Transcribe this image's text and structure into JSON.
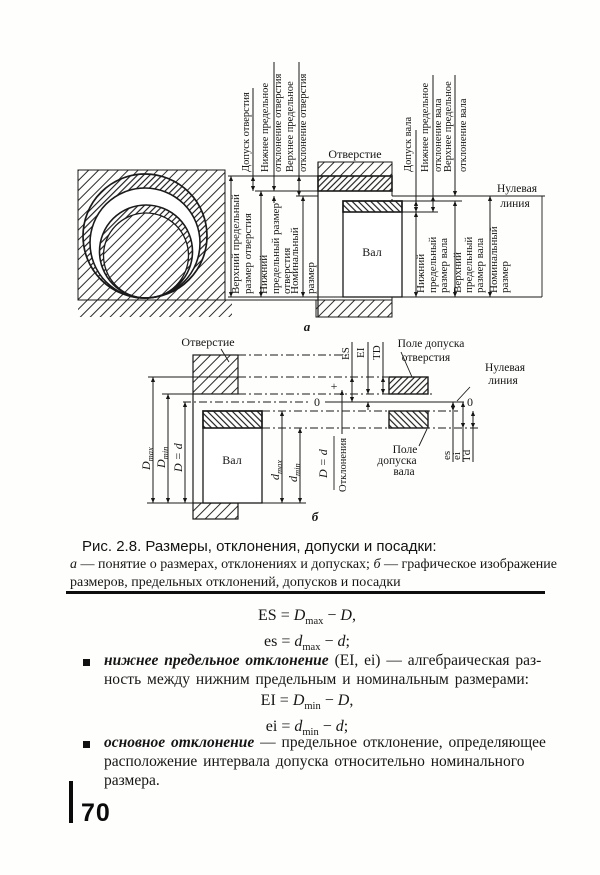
{
  "colors": {
    "ink": "#1a1a1a",
    "paper": "#fefefc"
  },
  "fig_a": {
    "hole": "Отверстие",
    "shaft": "Вал",
    "null1": "Нулевая",
    "null2": "линия",
    "tag": "а",
    "t1": "Допуск отверстия",
    "t2a": "Нижнее предельное",
    "t2b": "отклонение отверстия",
    "t3a": "Верхнее предельное",
    "t3b": "отклонение отверстия",
    "t4": "Допуск вала",
    "t5a": "Нижнее предельное",
    "t5b": "отклонение вала",
    "t6a": "Верхнее предельное",
    "t6b": "отклонение вала",
    "l1a": "Верхний предельный",
    "l1b": "размер отверстия",
    "l2a": "Нижний",
    "l2b": "предельный размер",
    "l2c": "отверстия",
    "l3a": "Номинальный",
    "l3b": "размер",
    "r1a": "Нижний",
    "r1b": "предельный",
    "r1c": "размер вала",
    "r2a": "Верхний",
    "r2b": "предельный",
    "r2c": "размер вала",
    "r3a": "Номинальный",
    "r3b": "размер"
  },
  "fig_b": {
    "hole": "Отверстие",
    "shaft": "Вал",
    "tag": "б",
    "dmax_v": "D",
    "dmax_s": "max",
    "dmin_v": "D",
    "dmin_s": "min",
    "dd": "D = d",
    "sdmax_v": "d",
    "sdmax_s": "max",
    "sdmin_v": "d",
    "sdmin_s": "min",
    "es_h": "ES",
    "ei_h": "EI",
    "td_h": "TD",
    "es_s": "es",
    "ei_s": "ei",
    "td_s": "Td",
    "plus": "+",
    "zero_l": "0",
    "zero_r": "0",
    "field_hole1": "Поле допуска",
    "field_hole2": "отверстия",
    "null1": "Нулевая",
    "null2": "линия",
    "field_shaft1": "Поле",
    "field_shaft2": "допуска",
    "field_shaft3": "вала",
    "axis_num": "D = d",
    "axis_den": "Отклонения"
  },
  "caption": {
    "title": "Рис. 2.8. Размеры, отклонения, допуски и посадки:",
    "legend_a": "а",
    "legend_a_text": " — понятие о размерах, отклонениях и допусках; ",
    "legend_b": "б",
    "legend_b_text": " — графическое изображение",
    "legend_line2": "размеров, предельных отклонений, допусков и посадки"
  },
  "formulas": {
    "f1": {
      "lhs": "ES",
      "eq": " = ",
      "v1": "D",
      "s1": "max",
      "op": " − ",
      "v2": "D",
      "end": ","
    },
    "f2": {
      "lhs": "es",
      "eq": " = ",
      "v1": "d",
      "s1": "max",
      "op": " − ",
      "v2": "d",
      "end": ";"
    },
    "f3": {
      "lhs": "EI",
      "eq": " = ",
      "v1": "D",
      "s1": "min",
      "op": " − ",
      "v2": "D",
      "end": ","
    },
    "f4": {
      "lhs": "ei",
      "eq": " = ",
      "v1": "d",
      "s1": "min",
      "op": " − ",
      "v2": "d",
      "end": ";"
    }
  },
  "bullets": {
    "b1_bold": "нижнее предельное отклонение",
    "b1_rest": " (EI, ei) — алгебраическая раз-",
    "b1_line2": "ность между нижним предельным и номинальным размерами:",
    "b2_bold": "основное отклонение",
    "b2_rest": " — предельное отклонение, определяющее",
    "b2_line2": "расположение интервала допуска относительно номинального",
    "b2_line3": "размера."
  },
  "page_number": "70"
}
